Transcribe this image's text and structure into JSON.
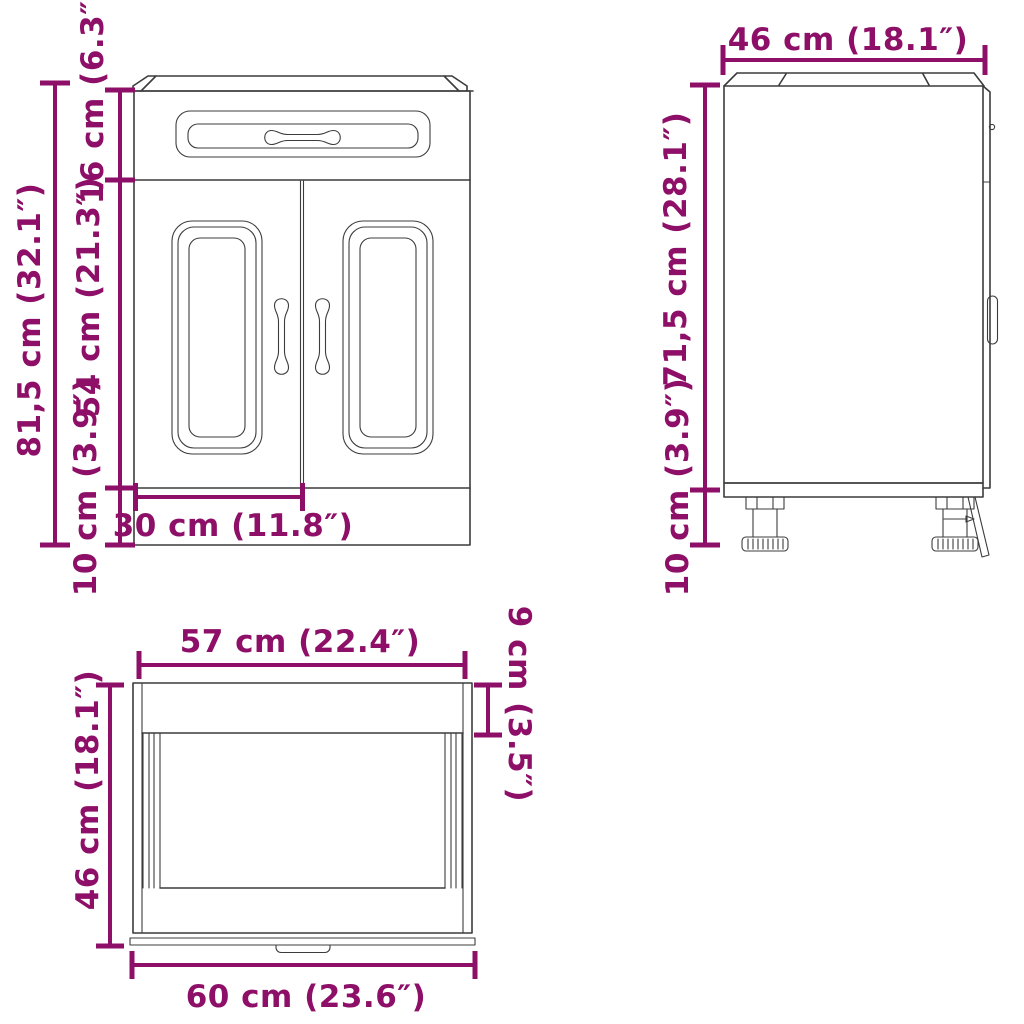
{
  "colors": {
    "dimension": "#8E0F68",
    "line": "#3C3C3C",
    "background": "#FFFFFF"
  },
  "views": {
    "front": {
      "labels": {
        "total_height": "81,5 cm (32.1″)",
        "drawer_height": "16 cm (6.3″)",
        "door_height": "54 cm (21.3″)",
        "plinth_height": "10 cm (3.9″)",
        "door_width": "30 cm (11.8″)"
      }
    },
    "side": {
      "labels": {
        "depth": "46 cm (18.1″)",
        "body_height": "71,5 cm (28.1″)",
        "leg_height": "10 cm (3.9″)"
      }
    },
    "top": {
      "labels": {
        "inner_width": "57 cm (22.4″)",
        "top_band_depth": "9 cm (3.5″)",
        "depth": "46 cm (18.1″)",
        "outer_width": "60 cm (23.6″)"
      }
    }
  }
}
